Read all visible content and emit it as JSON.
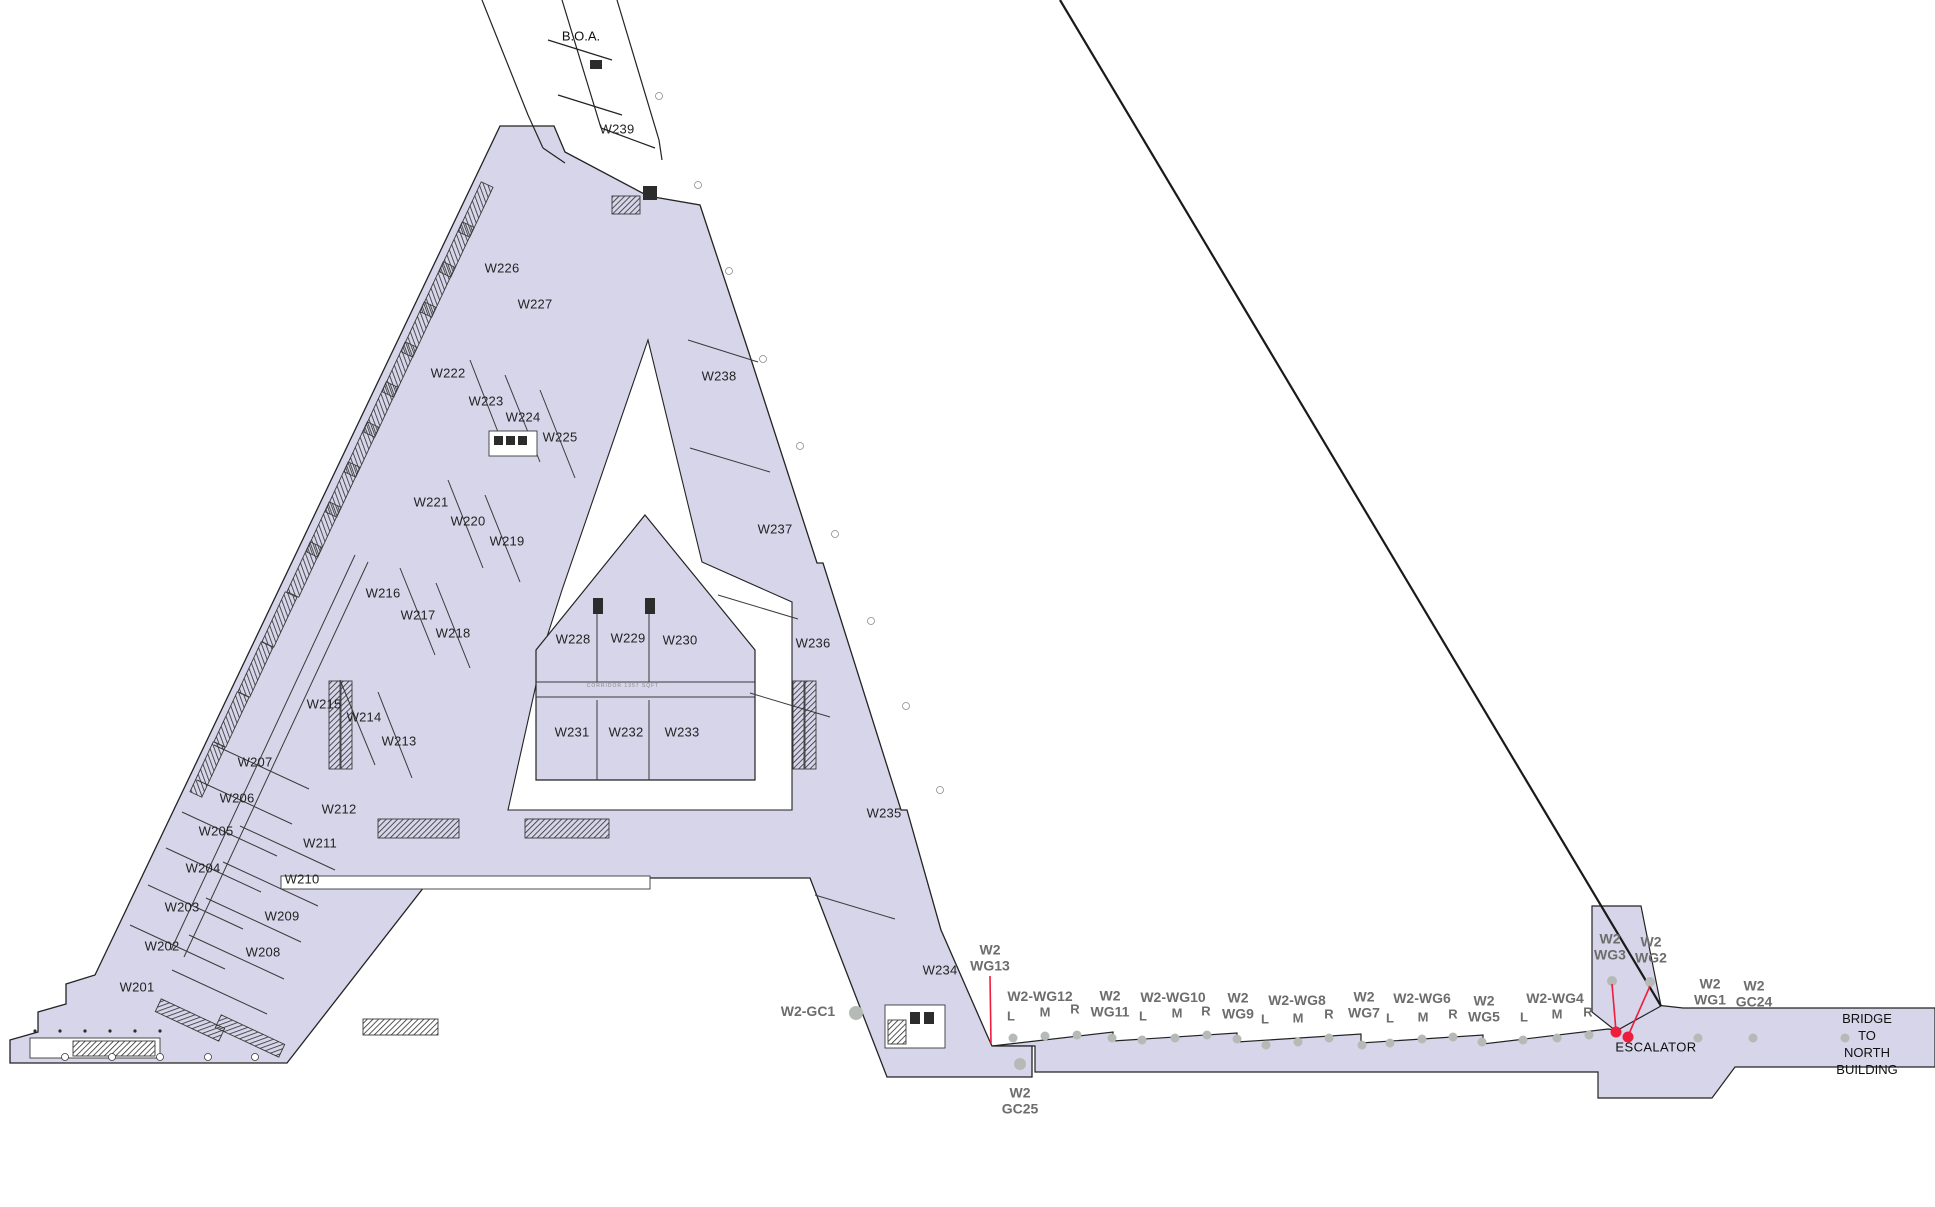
{
  "colors": {
    "floor_fill": "#d7d5e9",
    "outline": "#232323",
    "wall": "#3a3a3a",
    "hatch": "#2c2c2c",
    "red": "#ee1d3c",
    "dot": "#b6bab6",
    "gray_label": "#6d6d6d",
    "room_label": "#232323"
  },
  "rooms": [
    {
      "id": "W201",
      "x": 137,
      "y": 987
    },
    {
      "id": "W202",
      "x": 162,
      "y": 946
    },
    {
      "id": "W203",
      "x": 182,
      "y": 907
    },
    {
      "id": "W204",
      "x": 203,
      "y": 868
    },
    {
      "id": "W205",
      "x": 216,
      "y": 831
    },
    {
      "id": "W206",
      "x": 237,
      "y": 798
    },
    {
      "id": "W207",
      "x": 255,
      "y": 762
    },
    {
      "id": "W208",
      "x": 263,
      "y": 952
    },
    {
      "id": "W209",
      "x": 282,
      "y": 916
    },
    {
      "id": "W210",
      "x": 302,
      "y": 879
    },
    {
      "id": "W211",
      "x": 320,
      "y": 843
    },
    {
      "id": "W212",
      "x": 339,
      "y": 809
    },
    {
      "id": "W213",
      "x": 399,
      "y": 741
    },
    {
      "id": "W214",
      "x": 364,
      "y": 717
    },
    {
      "id": "W215",
      "x": 324,
      "y": 704
    },
    {
      "id": "W216",
      "x": 383,
      "y": 593
    },
    {
      "id": "W217",
      "x": 418,
      "y": 615
    },
    {
      "id": "W218",
      "x": 453,
      "y": 633
    },
    {
      "id": "W219",
      "x": 507,
      "y": 541
    },
    {
      "id": "W220",
      "x": 468,
      "y": 521
    },
    {
      "id": "W221",
      "x": 431,
      "y": 502
    },
    {
      "id": "W222",
      "x": 448,
      "y": 373
    },
    {
      "id": "W223",
      "x": 486,
      "y": 401
    },
    {
      "id": "W224",
      "x": 523,
      "y": 417
    },
    {
      "id": "W225",
      "x": 560,
      "y": 437
    },
    {
      "id": "W226",
      "x": 502,
      "y": 268
    },
    {
      "id": "W227",
      "x": 535,
      "y": 304
    },
    {
      "id": "W228",
      "x": 573,
      "y": 639
    },
    {
      "id": "W229",
      "x": 628,
      "y": 638
    },
    {
      "id": "W230",
      "x": 680,
      "y": 640
    },
    {
      "id": "W231",
      "x": 572,
      "y": 732
    },
    {
      "id": "W232",
      "x": 626,
      "y": 732
    },
    {
      "id": "W233",
      "x": 682,
      "y": 732
    },
    {
      "id": "W234",
      "x": 940,
      "y": 970
    },
    {
      "id": "W235",
      "x": 884,
      "y": 813
    },
    {
      "id": "W236",
      "x": 813,
      "y": 643
    },
    {
      "id": "W237",
      "x": 775,
      "y": 529
    },
    {
      "id": "W238",
      "x": 719,
      "y": 376
    },
    {
      "id": "W239",
      "x": 617,
      "y": 129
    }
  ],
  "wall_graphics": [
    {
      "id": "w2-wg13",
      "text": "W2\nWG13",
      "x": 990,
      "y": 958
    },
    {
      "id": "w2-gc1",
      "text": "W2-GC1",
      "x": 808,
      "y": 1012
    },
    {
      "id": "w2-wg12",
      "text": "W2-WG12",
      "x": 1040,
      "y": 997
    },
    {
      "id": "w2-wg11",
      "text": "W2\nWG11",
      "x": 1110,
      "y": 1004
    },
    {
      "id": "w2-wg10",
      "text": "W2-WG10",
      "x": 1173,
      "y": 998
    },
    {
      "id": "w2-wg9",
      "text": "W2\nWG9",
      "x": 1238,
      "y": 1006
    },
    {
      "id": "w2-wg8",
      "text": "W2-WG8",
      "x": 1297,
      "y": 1001
    },
    {
      "id": "w2-wg7",
      "text": "W2\nWG7",
      "x": 1364,
      "y": 1005
    },
    {
      "id": "w2-wg6",
      "text": "W2-WG6",
      "x": 1422,
      "y": 999
    },
    {
      "id": "w2-wg5",
      "text": "W2\nWG5",
      "x": 1484,
      "y": 1009
    },
    {
      "id": "w2-wg4",
      "text": "W2-WG4",
      "x": 1555,
      "y": 999
    },
    {
      "id": "w2-wg3",
      "text": "W2\nWG3",
      "x": 1610,
      "y": 947
    },
    {
      "id": "w2-wg2",
      "text": "W2\nWG2",
      "x": 1651,
      "y": 950
    },
    {
      "id": "w2-wg1",
      "text": "W2\nWG1",
      "x": 1710,
      "y": 992
    },
    {
      "id": "w2-gc24",
      "text": "W2\nGC24",
      "x": 1754,
      "y": 994
    },
    {
      "id": "w2-gc25",
      "text": "W2\nGC25",
      "x": 1020,
      "y": 1101
    }
  ],
  "lmr_labels": [
    {
      "text": "L",
      "x": 1011,
      "y": 1016
    },
    {
      "text": "M",
      "x": 1045,
      "y": 1012
    },
    {
      "text": "R",
      "x": 1075,
      "y": 1009
    },
    {
      "text": "L",
      "x": 1143,
      "y": 1016
    },
    {
      "text": "M",
      "x": 1177,
      "y": 1013
    },
    {
      "text": "R",
      "x": 1206,
      "y": 1011
    },
    {
      "text": "L",
      "x": 1265,
      "y": 1019
    },
    {
      "text": "M",
      "x": 1298,
      "y": 1018
    },
    {
      "text": "R",
      "x": 1329,
      "y": 1014
    },
    {
      "text": "L",
      "x": 1390,
      "y": 1018
    },
    {
      "text": "M",
      "x": 1423,
      "y": 1017
    },
    {
      "text": "R",
      "x": 1453,
      "y": 1014
    },
    {
      "text": "L",
      "x": 1524,
      "y": 1017
    },
    {
      "text": "M",
      "x": 1557,
      "y": 1014
    },
    {
      "text": "R",
      "x": 1588,
      "y": 1012
    }
  ],
  "annotations": {
    "boa": "B.O.A.",
    "escalator": "ESCALATOR",
    "bridge": "BRIDGE TO\nNORTH BUILDING",
    "corridor_note": "CORRIDOR    1357 SQFT"
  }
}
